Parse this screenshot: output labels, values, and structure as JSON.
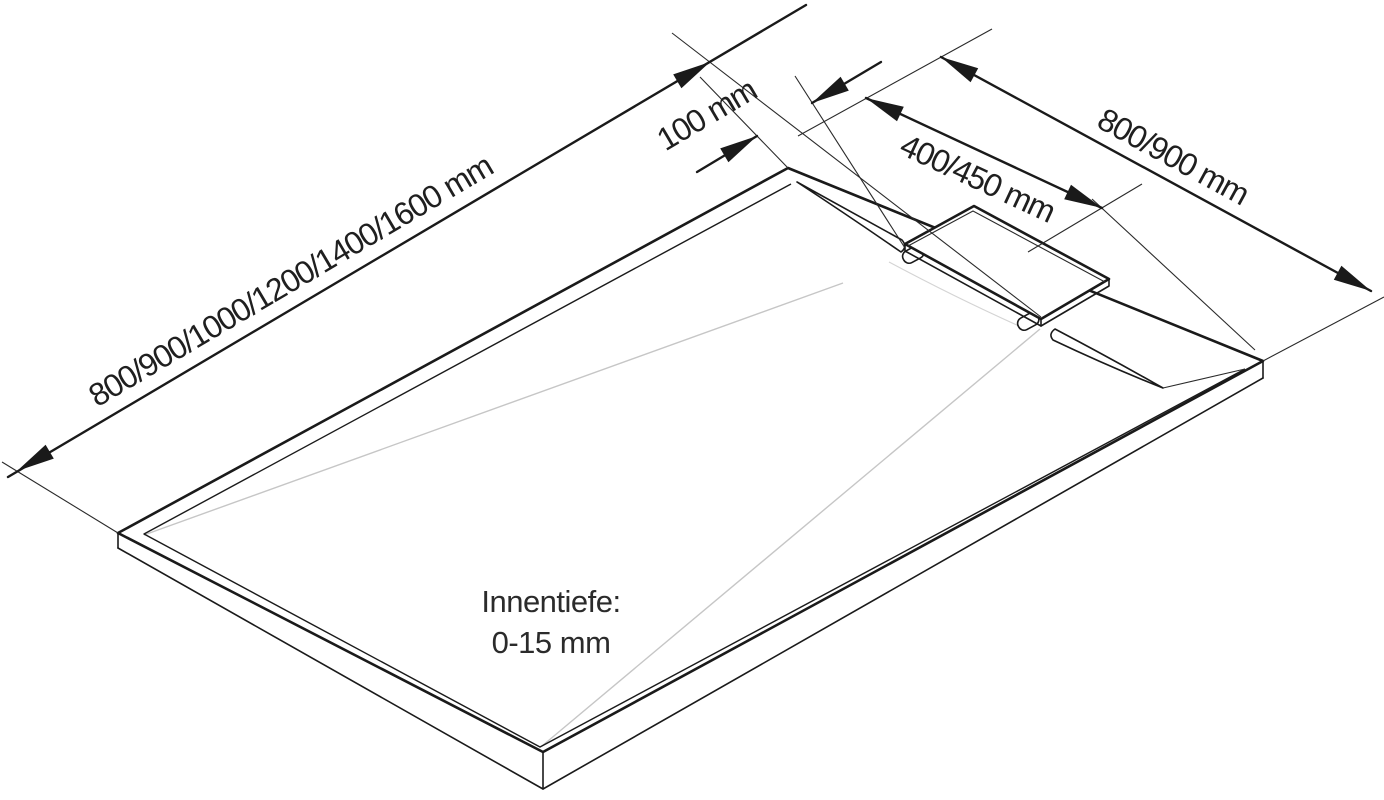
{
  "drawing": {
    "kind": "shower-tray-technical-drawing",
    "dimensions": {
      "length": {
        "label": "800/900/1000/1200/1400/1600 mm"
      },
      "offset": {
        "label": "100 mm"
      },
      "drain": {
        "label": "400/450 mm"
      },
      "width": {
        "label": "800/900 mm"
      }
    },
    "annotation": {
      "line1": "Innentiefe:",
      "line2": "0-15 mm"
    },
    "colors": {
      "ink": "#1a1a1a",
      "slope_lines": "#c6c6c6",
      "background": "#ffffff"
    }
  }
}
